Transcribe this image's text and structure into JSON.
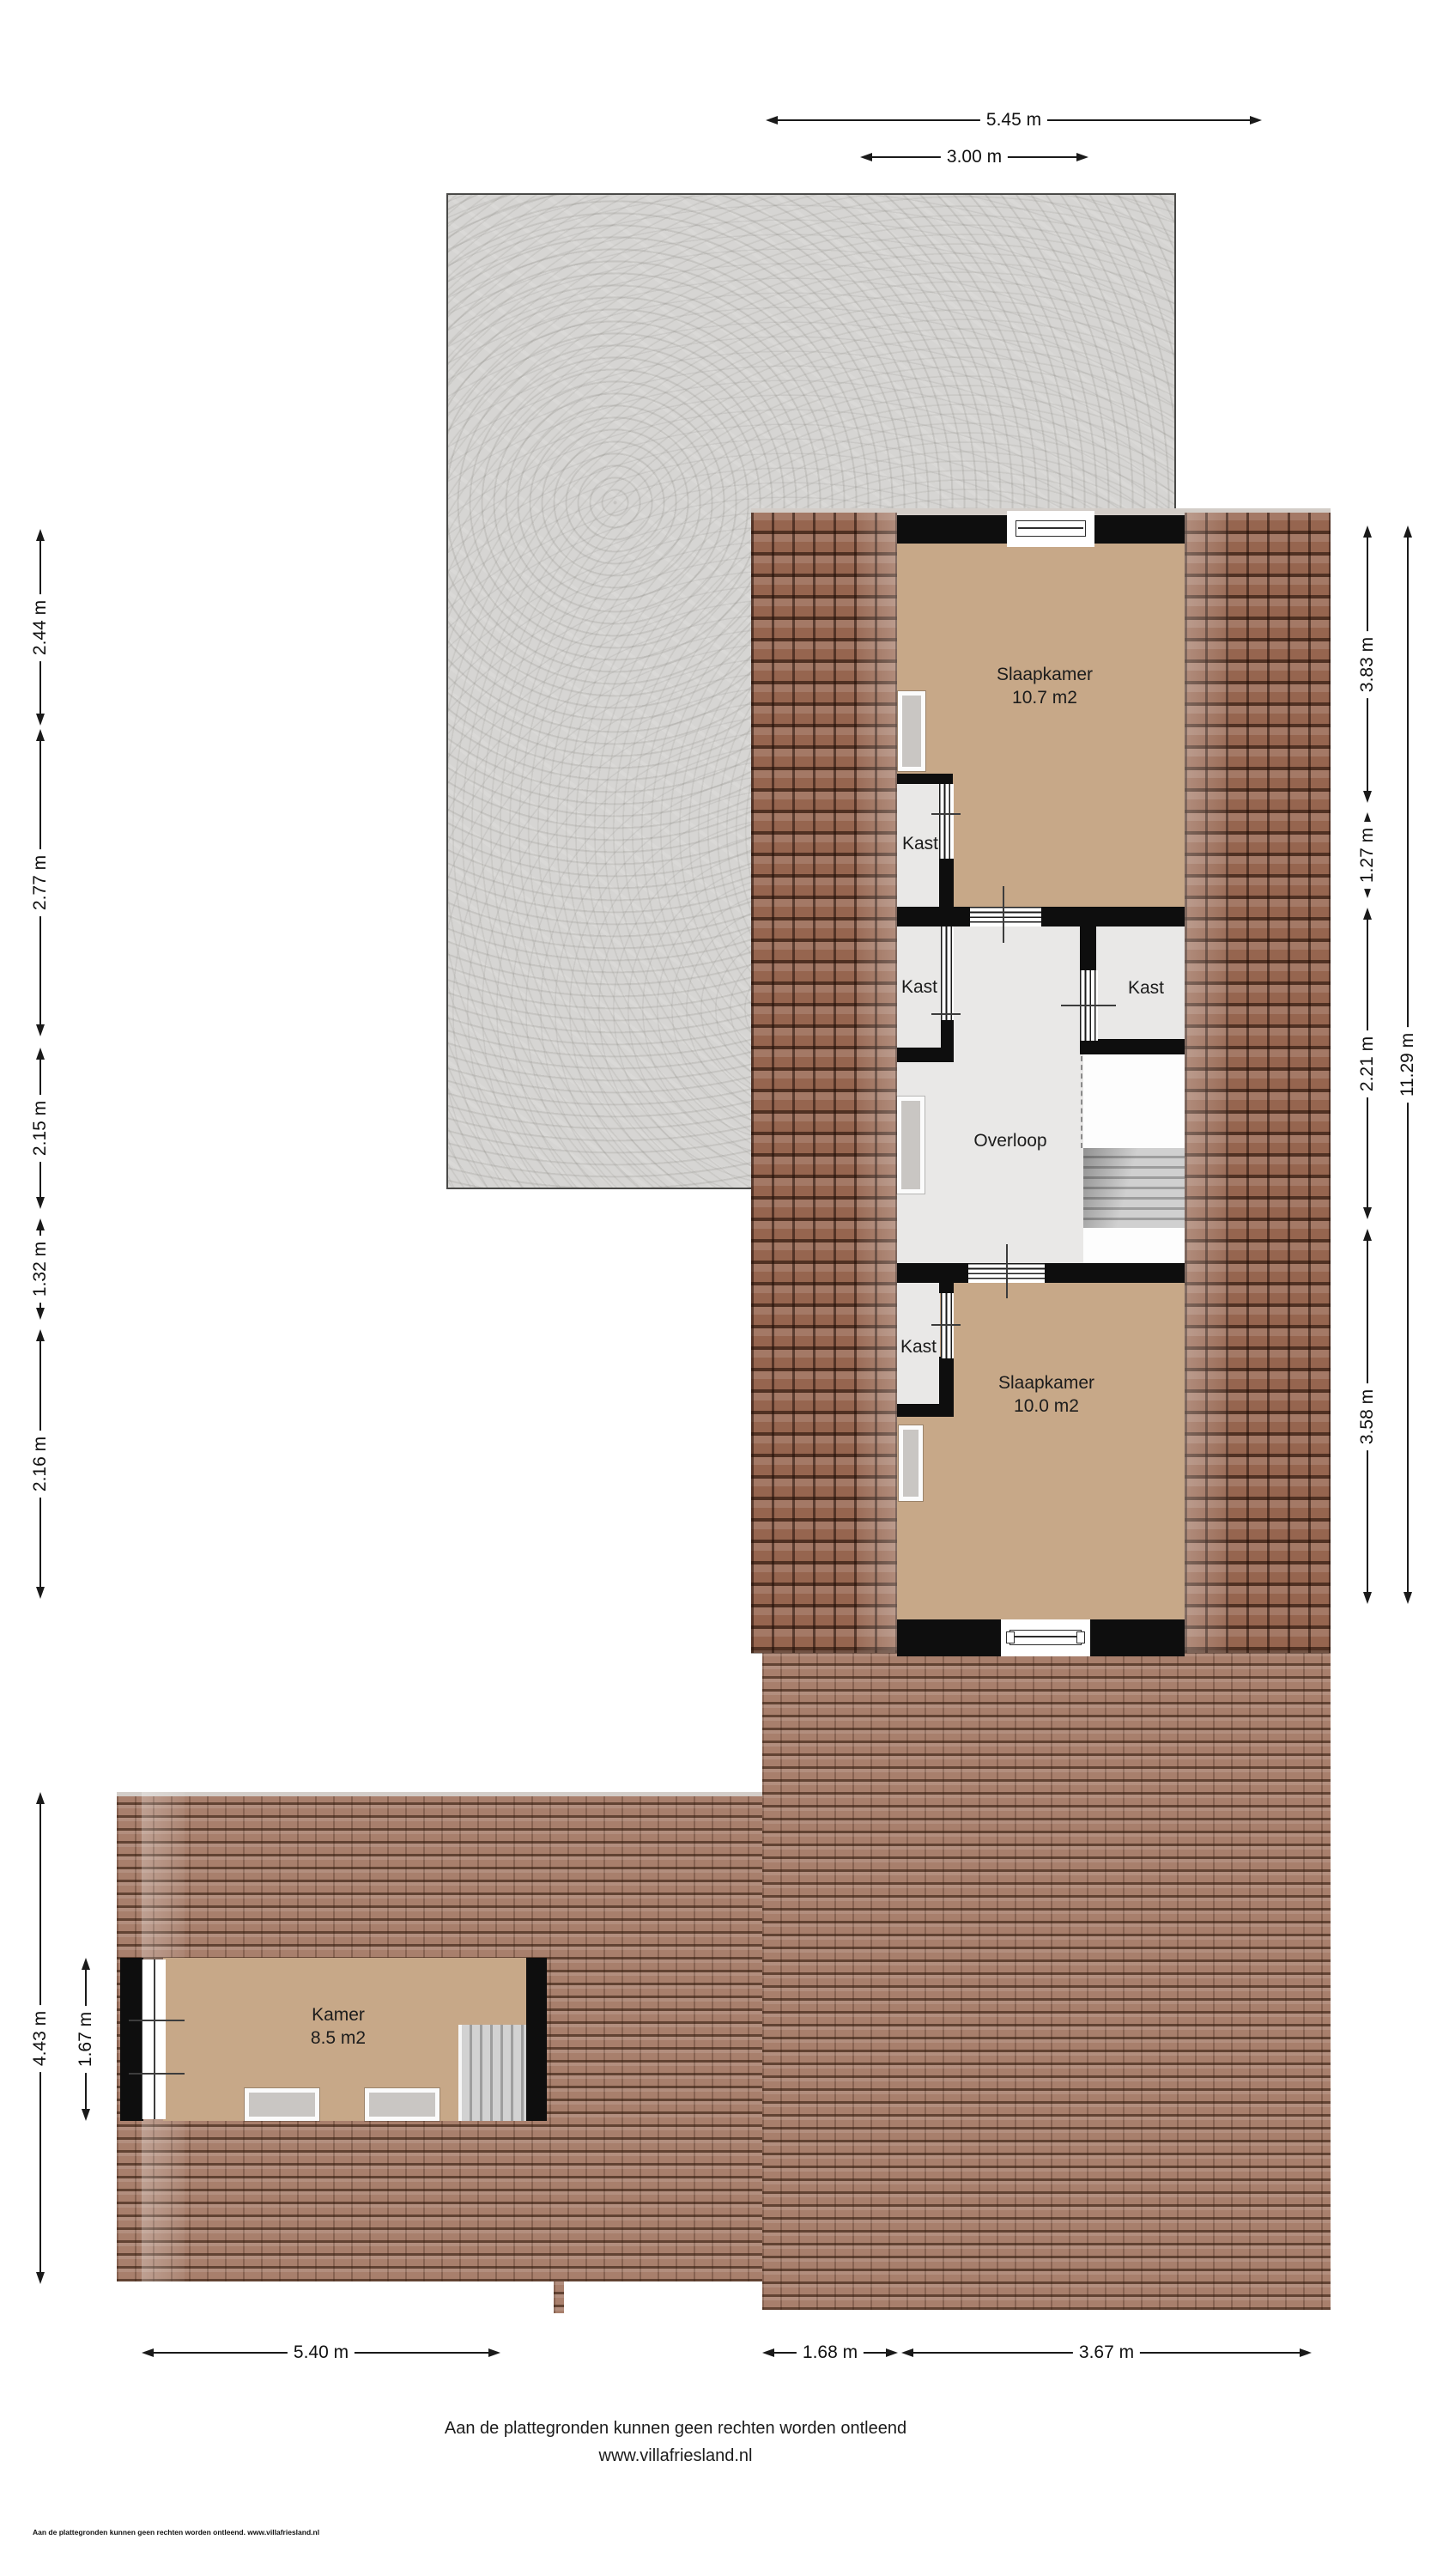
{
  "page": {
    "footer_line1": "Aan de plattegronden kunnen geen rechten worden ontleend",
    "footer_line2": "www.villafriesland.nl",
    "disclaimer_small": "Aan de plattegronden kunnen geen rechten worden ontleend. www.villafriesland.nl"
  },
  "rooms": {
    "slaapkamer_top": {
      "name": "Slaapkamer",
      "area": "10.7 m2"
    },
    "slaapkamer_bottom": {
      "name": "Slaapkamer",
      "area": "10.0 m2"
    },
    "kamer": {
      "name": "Kamer",
      "area": "8.5 m2"
    },
    "overloop": {
      "name": "Overloop"
    },
    "kast_1": {
      "name": "Kast"
    },
    "kast_2": {
      "name": "Kast"
    },
    "kast_3": {
      "name": "Kast"
    },
    "kast_4": {
      "name": "Kast"
    }
  },
  "dimensions": {
    "top": {
      "d545": "5.45 m",
      "d300": "3.00 m"
    },
    "left": {
      "d244": "2.44 m",
      "d277": "2.77 m",
      "d215": "2.15 m",
      "d132": "1.32 m",
      "d216": "2.16 m"
    },
    "right": {
      "d383": "3.83 m",
      "d127": "1.27 m",
      "d221": "2.21 m",
      "d358": "3.58 m",
      "d1129": "11.29 m"
    },
    "bottom": {
      "d540": "5.40 m",
      "d168": "1.68 m",
      "d367": "3.67 m"
    },
    "kamer": {
      "d443": "4.43 m",
      "d167": "1.67 m"
    }
  },
  "colors": {
    "wall": "#0e0e0e",
    "floor_tan": "#c7a888",
    "floor_light": "#e9e8e7",
    "roof_side": "#96654f",
    "roof_main": "#a87f6c",
    "concrete": "#d6d5d3"
  }
}
